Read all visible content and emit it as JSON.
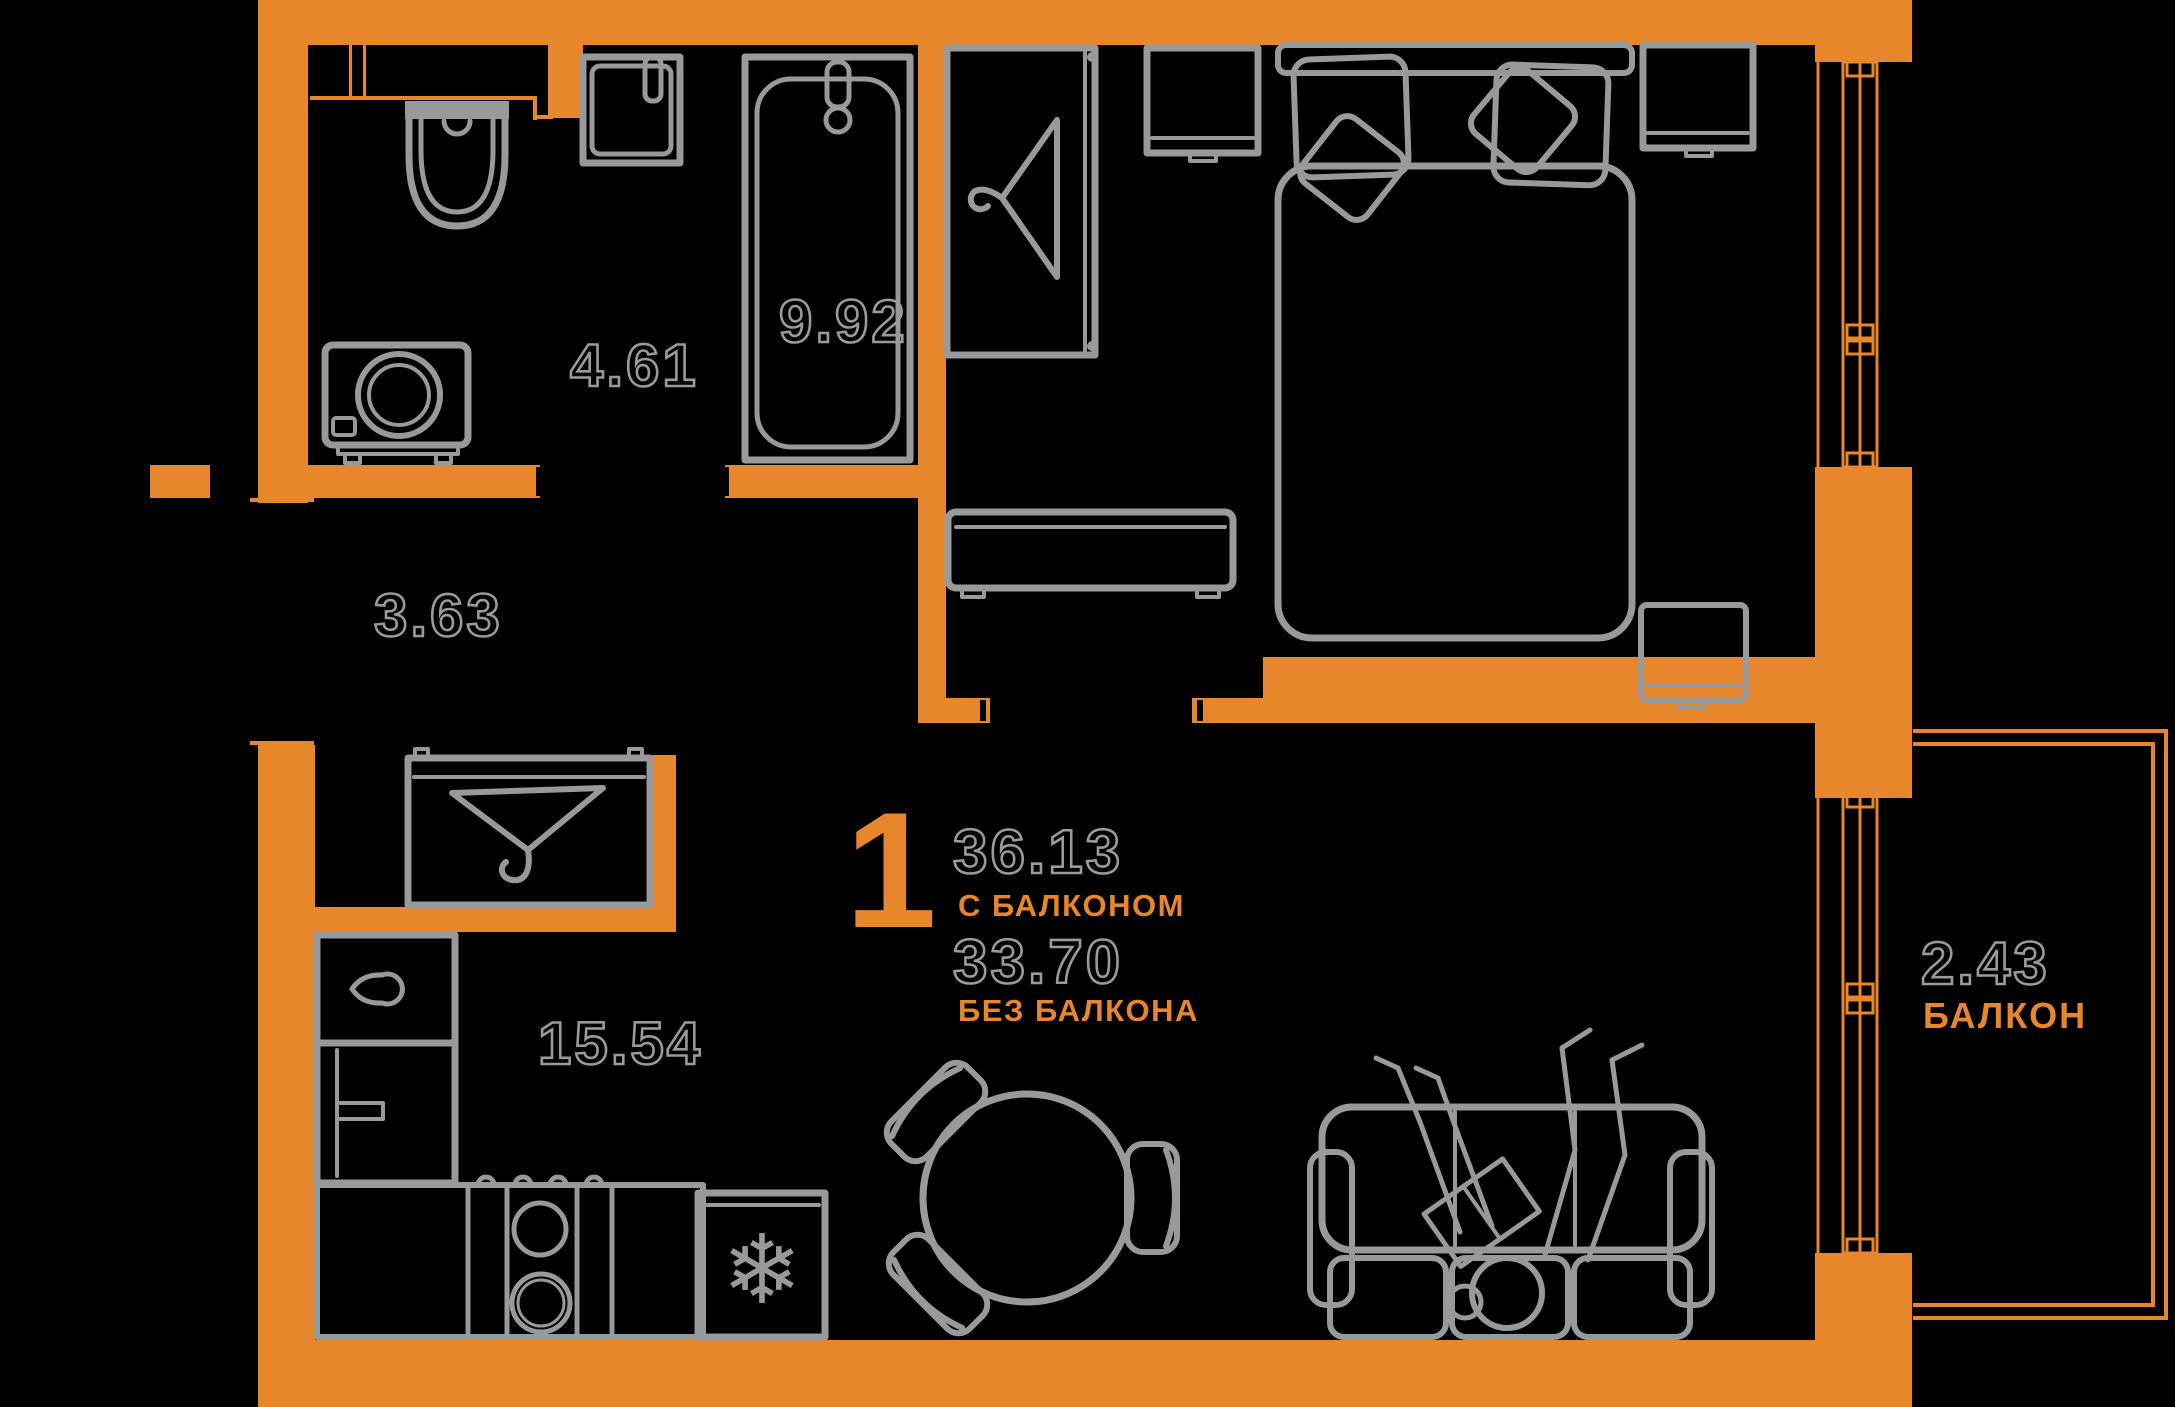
{
  "colors": {
    "background": "#000000",
    "wall": "#E8862B",
    "furniture_line": "#97999B",
    "outline_text": "#9A9A9A",
    "accent_text": "#E8862B"
  },
  "rooms": {
    "bathroom": {
      "area": "4.61"
    },
    "hallway": {
      "area": "3.63"
    },
    "bedroom": {
      "area": "9.92"
    },
    "kitchen_living": {
      "area": "15.54"
    },
    "balcony": {
      "area": "2.43",
      "label": "БАЛКОН"
    }
  },
  "summary": {
    "rooms_count": "1",
    "area_with_balcony": "36.13",
    "with_balcony_label": "С БАЛКОНОМ",
    "area_without_balcony": "33.70",
    "without_balcony_label": "БЕЗ БАЛКОНА"
  },
  "furniture": [
    "ventilation-shaft",
    "toilet",
    "bathroom-sink",
    "bathtub",
    "washing-machine",
    "entrance-door",
    "hall-closet",
    "coat-hanger",
    "wardrobe",
    "bed",
    "pillows",
    "nightstand",
    "tv-stand",
    "foot-cabinet",
    "window",
    "balcony-door",
    "kitchen-sink-cabinet",
    "fridge",
    "stove",
    "kitchen-counter",
    "freezer",
    "snowflake-icon",
    "dining-table",
    "chair",
    "sofa",
    "person-reading"
  ]
}
